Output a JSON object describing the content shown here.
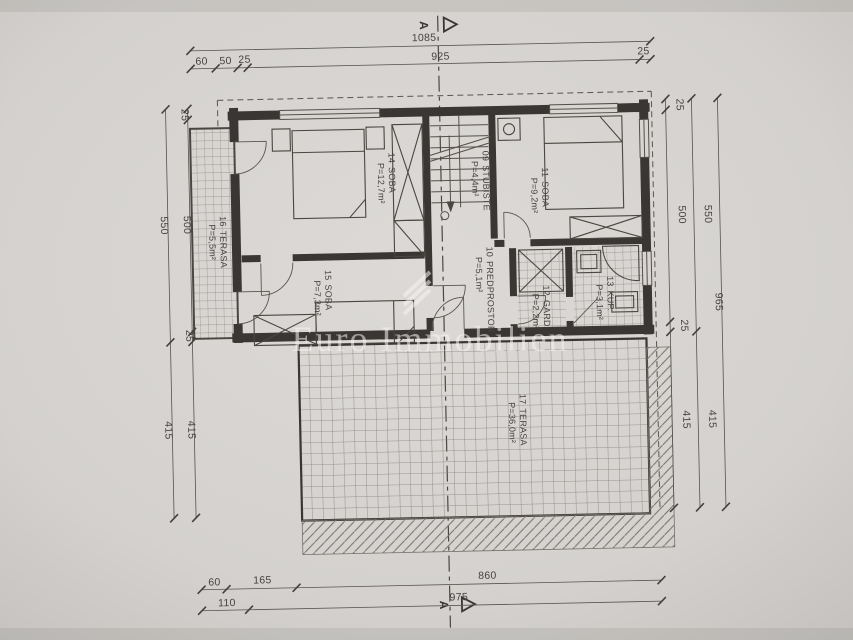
{
  "watermark": {
    "text": "Euro Immobilien"
  },
  "section": {
    "marker": "A"
  },
  "rooms": {
    "stubiste": {
      "num": "09",
      "name": "STUBIŠTE",
      "area": "P=4,4m²"
    },
    "predprostor": {
      "num": "10",
      "name": "PREDPROSTOR",
      "area": "P=5,1m²"
    },
    "soba11": {
      "num": "11",
      "name": "SOBA",
      "area": "P=9,2m²"
    },
    "gard": {
      "num": "12",
      "name": "GARD.",
      "area": "P=2,2m²"
    },
    "kup": {
      "num": "13",
      "name": "KUP.",
      "area": "P=3,1m²"
    },
    "soba14": {
      "num": "14",
      "name": "SOBA",
      "area": "P=12,7m²"
    },
    "soba15": {
      "num": "15",
      "name": "SOBA",
      "area": "P=7,3m²"
    },
    "terasa16": {
      "num": "16",
      "name": "TERASA",
      "area": "P=5,5m²"
    },
    "terasa17": {
      "num": "17",
      "name": "TERASA",
      "area": "P=36,0m²"
    }
  },
  "dimensions": {
    "top": {
      "total": "1085",
      "segments": [
        "60",
        "50",
        "25",
        "925",
        "25"
      ]
    },
    "bottom": {
      "row1": [
        "60",
        "165",
        "860"
      ],
      "row2": [
        "110",
        "975"
      ]
    },
    "left": {
      "outer": [
        "550",
        "415"
      ],
      "inner": [
        "25",
        "500",
        "25",
        "415"
      ]
    },
    "right": {
      "inner": [
        "25",
        "500",
        "25",
        "415"
      ],
      "mid": [
        "550",
        "415"
      ],
      "outer": [
        "965"
      ]
    }
  }
}
